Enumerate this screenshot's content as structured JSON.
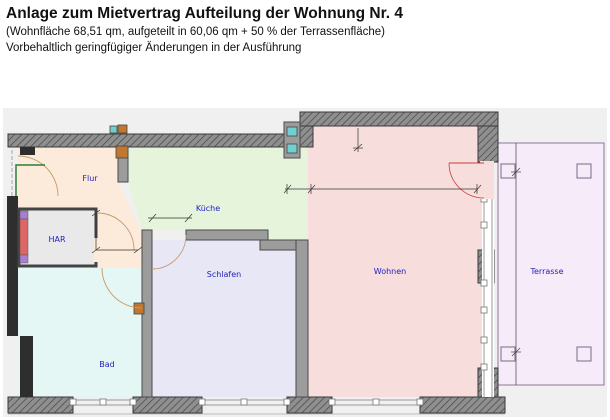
{
  "header": {
    "title": "Anlage zum Mietvertrag Aufteilung der Wohnung Nr. 4",
    "subtitle": "(Wohnfläche 68,51 qm, aufgeteilt in 60,06 qm + 50 % der Terrassenfläche)",
    "note": "Vorbehaltlich geringfügiger Änderungen in der Ausführung"
  },
  "rooms": {
    "flur": "Flur",
    "kueche": "Küche",
    "har": "HAR",
    "schlafen": "Schlafen",
    "bad": "Bad",
    "wohnen": "Wohnen",
    "terrasse": "Terrasse"
  },
  "colors": {
    "plan_bg": "#f0f0f0",
    "flur": "#fcebdb",
    "kueche": "#e6f4dc",
    "har": "#e9e9e9",
    "schlafen": "#e8e7f5",
    "bad": "#e5f7f5",
    "wohnen": "#f8dddd",
    "terrasse": "#f6ebf8",
    "label": "#2222c0",
    "wall_gray": "#9c9c9c",
    "wall_dark": "#2e2e2e",
    "accent_cyan": "#72cfcf",
    "accent_orange": "#c1772f",
    "shaft_red": "#e06565",
    "shaft_purple": "#a87fd0",
    "door_green": "#2f7d33",
    "door_red": "#cc3b3b",
    "door_arc": "#c49a6c"
  }
}
